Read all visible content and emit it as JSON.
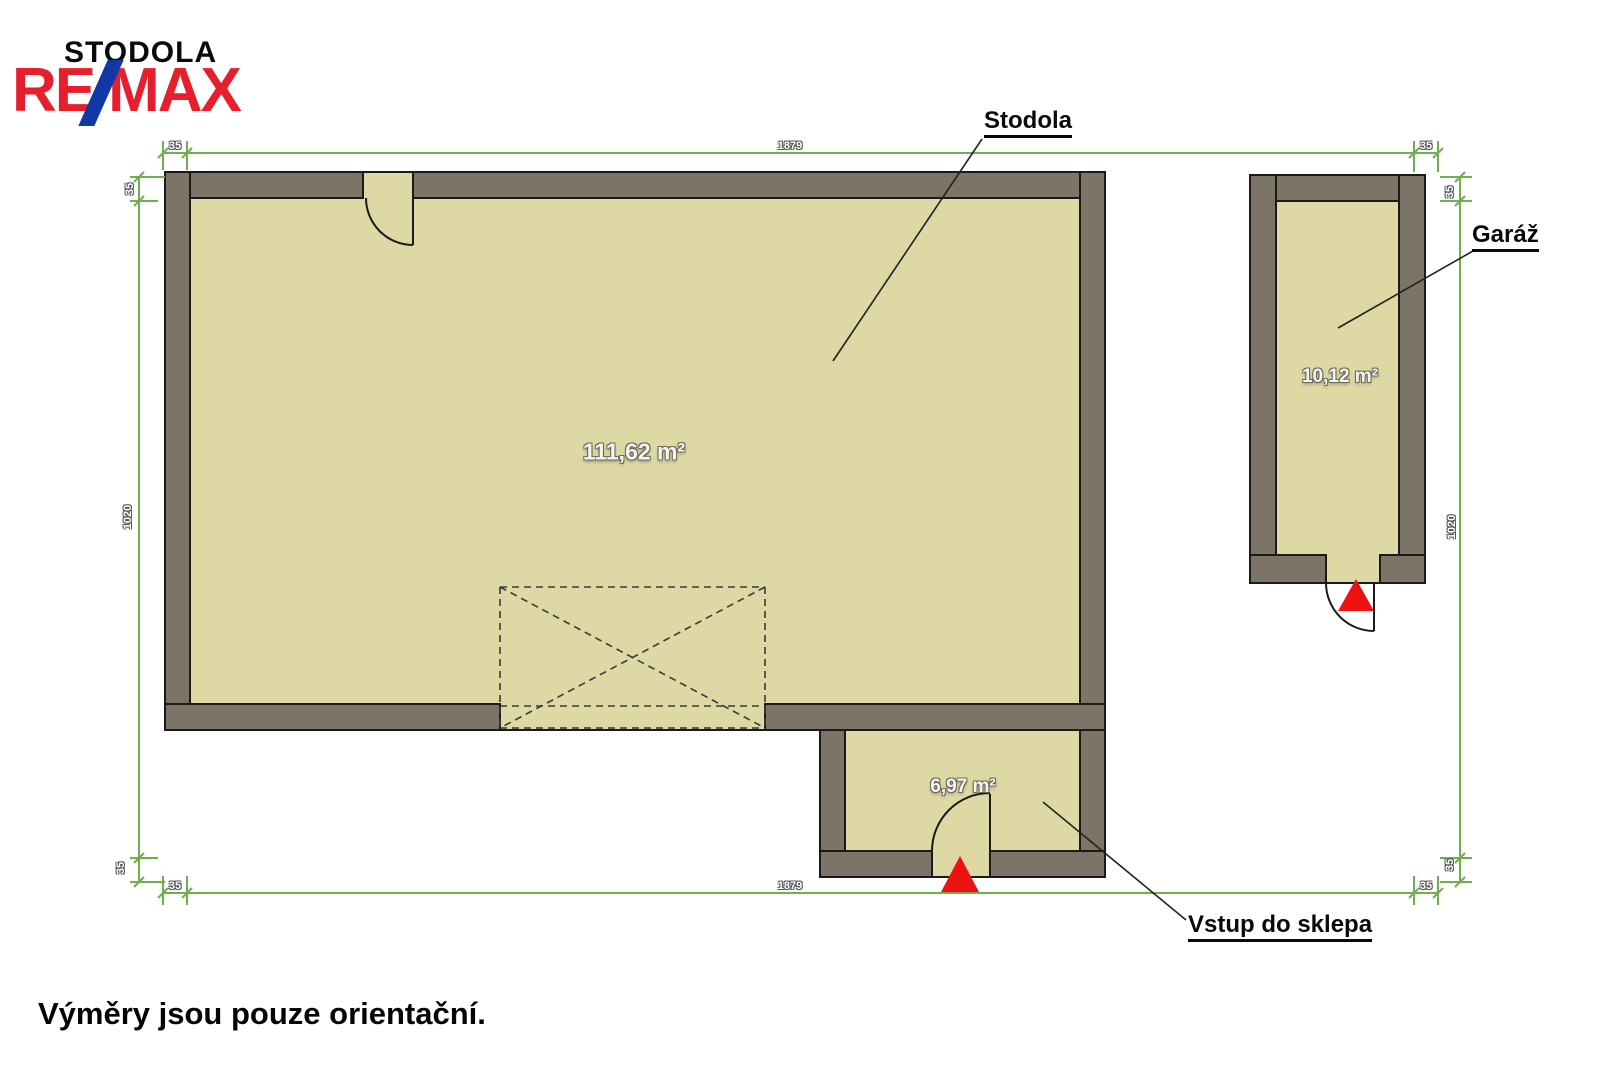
{
  "logo": {
    "name": "STODOLA",
    "remax_re": "RE",
    "remax_max": "MAX"
  },
  "callouts": {
    "stodola": "Stodola",
    "garaz": "Garáž",
    "vstup_do_sklepa": "Vstup do sklepa"
  },
  "areas": {
    "stodola": "111,62 m²",
    "garaz": "10,12 m²",
    "sklep": "6,97 m²"
  },
  "dimensions": {
    "top_left": "35",
    "top_center": "1879",
    "top_right": "35",
    "bottom_left": "35",
    "bottom_center": "1879",
    "bottom_right": "35",
    "left_top": "35",
    "left_center": "1020",
    "left_bottom": "35",
    "right_top": "35",
    "right_center": "1020",
    "right_bottom": "35"
  },
  "footer": "Výměry jsou pouze orientační.",
  "colors": {
    "wall": "#7c7567",
    "floor": "#ddd8a4",
    "outline": "#1a1a1a",
    "dimension_green": "#6faf4f",
    "entry_arrow_red": "#ee1111",
    "remax_red": "#e61e2d",
    "remax_blue": "#1039a6"
  }
}
